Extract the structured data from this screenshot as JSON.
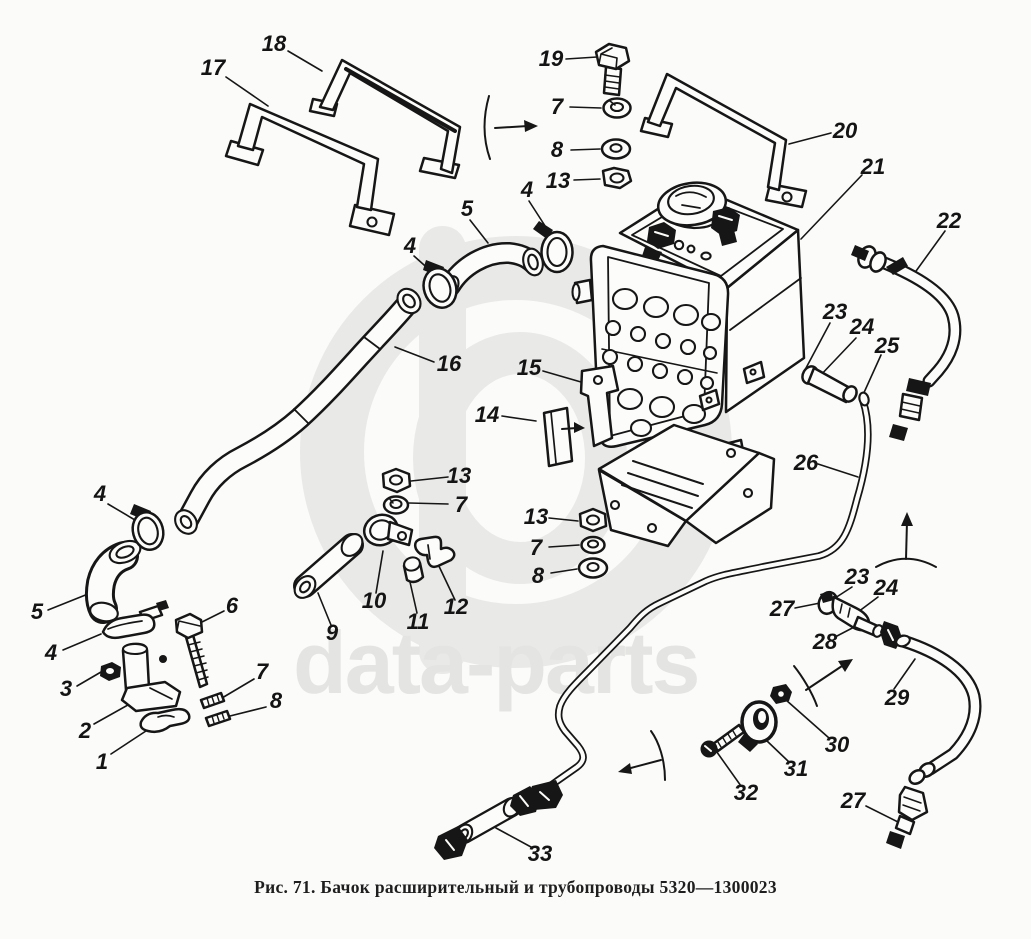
{
  "figure": {
    "caption": "Рис. 71. Бачок расширительный и трубопроводы 5320—1300023",
    "figure_number": "71",
    "title": "Бачок расширительный и трубопроводы",
    "part_number": "5320—1300023"
  },
  "watermark": {
    "text": "data-parts",
    "logo": "circle-phi-logo",
    "color": "#e4e4e2"
  },
  "diagram": {
    "type": "exploded-parts-diagram",
    "ink_color": "#161616",
    "callouts": [
      {
        "n": "17",
        "x": 213,
        "y": 68
      },
      {
        "n": "18",
        "x": 274,
        "y": 44
      },
      {
        "n": "19",
        "x": 551,
        "y": 59
      },
      {
        "n": "7",
        "x": 557,
        "y": 107
      },
      {
        "n": "8",
        "x": 557,
        "y": 150
      },
      {
        "n": "13",
        "x": 558,
        "y": 181
      },
      {
        "n": "4",
        "x": 527,
        "y": 190
      },
      {
        "n": "5",
        "x": 467,
        "y": 209
      },
      {
        "n": "4",
        "x": 410,
        "y": 246
      },
      {
        "n": "20",
        "x": 845,
        "y": 131
      },
      {
        "n": "21",
        "x": 873,
        "y": 167
      },
      {
        "n": "22",
        "x": 949,
        "y": 221
      },
      {
        "n": "23",
        "x": 835,
        "y": 312
      },
      {
        "n": "24",
        "x": 862,
        "y": 327
      },
      {
        "n": "25",
        "x": 887,
        "y": 346
      },
      {
        "n": "16",
        "x": 449,
        "y": 364
      },
      {
        "n": "15",
        "x": 529,
        "y": 368
      },
      {
        "n": "14",
        "x": 487,
        "y": 415
      },
      {
        "n": "13",
        "x": 459,
        "y": 476
      },
      {
        "n": "7",
        "x": 461,
        "y": 505
      },
      {
        "n": "13",
        "x": 536,
        "y": 517
      },
      {
        "n": "7",
        "x": 536,
        "y": 548
      },
      {
        "n": "8",
        "x": 538,
        "y": 576
      },
      {
        "n": "26",
        "x": 806,
        "y": 463
      },
      {
        "n": "4",
        "x": 100,
        "y": 494
      },
      {
        "n": "5",
        "x": 37,
        "y": 612
      },
      {
        "n": "4",
        "x": 51,
        "y": 653
      },
      {
        "n": "3",
        "x": 66,
        "y": 689
      },
      {
        "n": "2",
        "x": 85,
        "y": 731
      },
      {
        "n": "1",
        "x": 102,
        "y": 762
      },
      {
        "n": "6",
        "x": 232,
        "y": 606
      },
      {
        "n": "7",
        "x": 262,
        "y": 672
      },
      {
        "n": "8",
        "x": 276,
        "y": 701
      },
      {
        "n": "9",
        "x": 332,
        "y": 633
      },
      {
        "n": "10",
        "x": 374,
        "y": 601
      },
      {
        "n": "11",
        "x": 418,
        "y": 622
      },
      {
        "n": "12",
        "x": 456,
        "y": 607
      },
      {
        "n": "23",
        "x": 857,
        "y": 577
      },
      {
        "n": "24",
        "x": 886,
        "y": 588
      },
      {
        "n": "27",
        "x": 782,
        "y": 609
      },
      {
        "n": "28",
        "x": 825,
        "y": 642
      },
      {
        "n": "29",
        "x": 897,
        "y": 698
      },
      {
        "n": "30",
        "x": 837,
        "y": 745
      },
      {
        "n": "31",
        "x": 796,
        "y": 769
      },
      {
        "n": "32",
        "x": 746,
        "y": 793
      },
      {
        "n": "27",
        "x": 853,
        "y": 801
      },
      {
        "n": "33",
        "x": 540,
        "y": 854
      }
    ]
  }
}
